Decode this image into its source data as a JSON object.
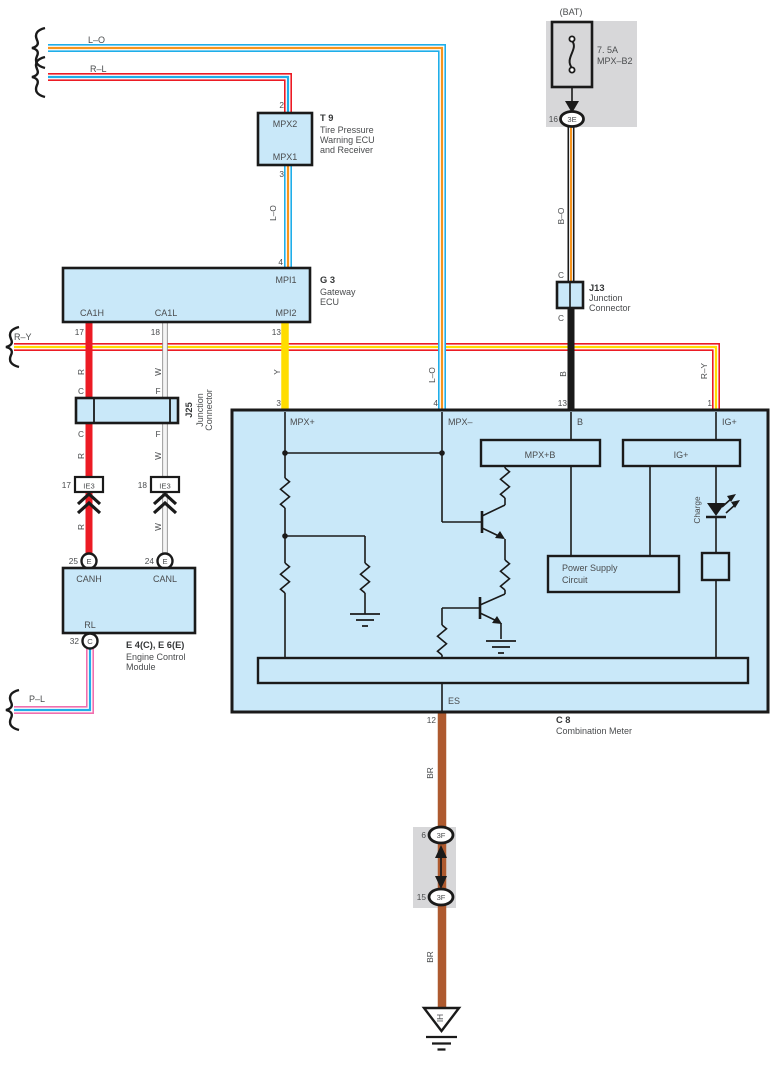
{
  "colors": {
    "cyan": "#1FAEE9",
    "orange": "#F7941D",
    "red": "#EC1B24",
    "yellow": "#FFDD00",
    "brown": "#AE5A2F",
    "pink": "#F06EAE",
    "wire_black": "#1A1A1A",
    "component_fill": "#C9E8F9",
    "shade_gray": "#D7D7D9",
    "text": "#4A4C4E"
  },
  "left_edge": {
    "lo": "L–O",
    "rl": "R–L",
    "ry": "R–Y",
    "pl": "P–L"
  },
  "wire_colors": {
    "lo_t9_g3": "L–O",
    "r_top": "R",
    "w_top": "W",
    "y": "Y",
    "c_top": "C",
    "f_top": "F",
    "c_bot": "C",
    "f_bot": "F",
    "r_mid": "R",
    "w_mid": "W",
    "r_bot": "R",
    "w_bot": "W",
    "bo": "B–O",
    "b": "B",
    "lo_meter": "L–O",
    "ry_meter": "R–Y",
    "br_top": "BR",
    "br_bot": "BR",
    "j13_c_top": "C",
    "j13_c_bot": "C"
  },
  "t9": {
    "id": "T 9",
    "name_line1": "Tire Pressure",
    "name_line2": "Warning ECU",
    "name_line3": "and Receiver",
    "pin_top": "2",
    "pin_bottom": "3",
    "terminal_top": "MPX2",
    "terminal_bottom": "MPX1"
  },
  "g3": {
    "id": "G 3",
    "name_line1": "Gateway",
    "name_line2": "ECU",
    "terminal_mpi1": "MPI1",
    "terminal_ca1h": "CA1H",
    "terminal_ca1l": "CA1L",
    "terminal_mpi2": "MPI2",
    "pin_mpi1": "4",
    "pin_ca1h": "17",
    "pin_ca1l": "18",
    "pin_mpi2": "13"
  },
  "j25": {
    "id": "J25",
    "name_line1": "Junction",
    "name_line2": "Connector"
  },
  "ie3_left": {
    "pin": "17",
    "label": "IE3"
  },
  "ie3_right": {
    "pin": "18",
    "label": "IE3"
  },
  "ecm": {
    "id": "E 4(C), E 6(E)",
    "name_line1": "Engine Control",
    "name_line2": "Module",
    "terminal_canh": "CANH",
    "terminal_canl": "CANL",
    "terminal_rl": "RL",
    "pin_canh": "25",
    "pin_canl": "24",
    "pin_rl": "32",
    "conn_canh": "E",
    "conn_canl": "E",
    "conn_rl": "C"
  },
  "fuse": {
    "bat": "(BAT)",
    "rating": "7. 5A",
    "name": "MPX–B2",
    "pin": "16",
    "connector": "3E"
  },
  "j13": {
    "id": "J13",
    "name_line1": "Junction",
    "name_line2": "Connector"
  },
  "meter": {
    "id": "C 8",
    "name": "Combination Meter",
    "terminal_mpx_plus": "MPX+",
    "terminal_mpx_minus": "MPX–",
    "terminal_b": "B",
    "terminal_ig": "IG+",
    "terminal_es": "ES",
    "pin_mpx_plus": "3",
    "pin_mpx_minus": "4",
    "pin_b": "13",
    "pin_ig": "1",
    "pin_es": "12",
    "inner_box_mpxb": "MPX+B",
    "inner_box_ig": "IG+",
    "psc_line1": "Power Supply",
    "psc_line2": "Circuit",
    "charge_label": "Charge"
  },
  "bottom_connectors": {
    "top_pin": "6",
    "top_label": "3F",
    "bottom_pin": "15",
    "bottom_label": "3F"
  },
  "ground": {
    "label": "IH"
  }
}
